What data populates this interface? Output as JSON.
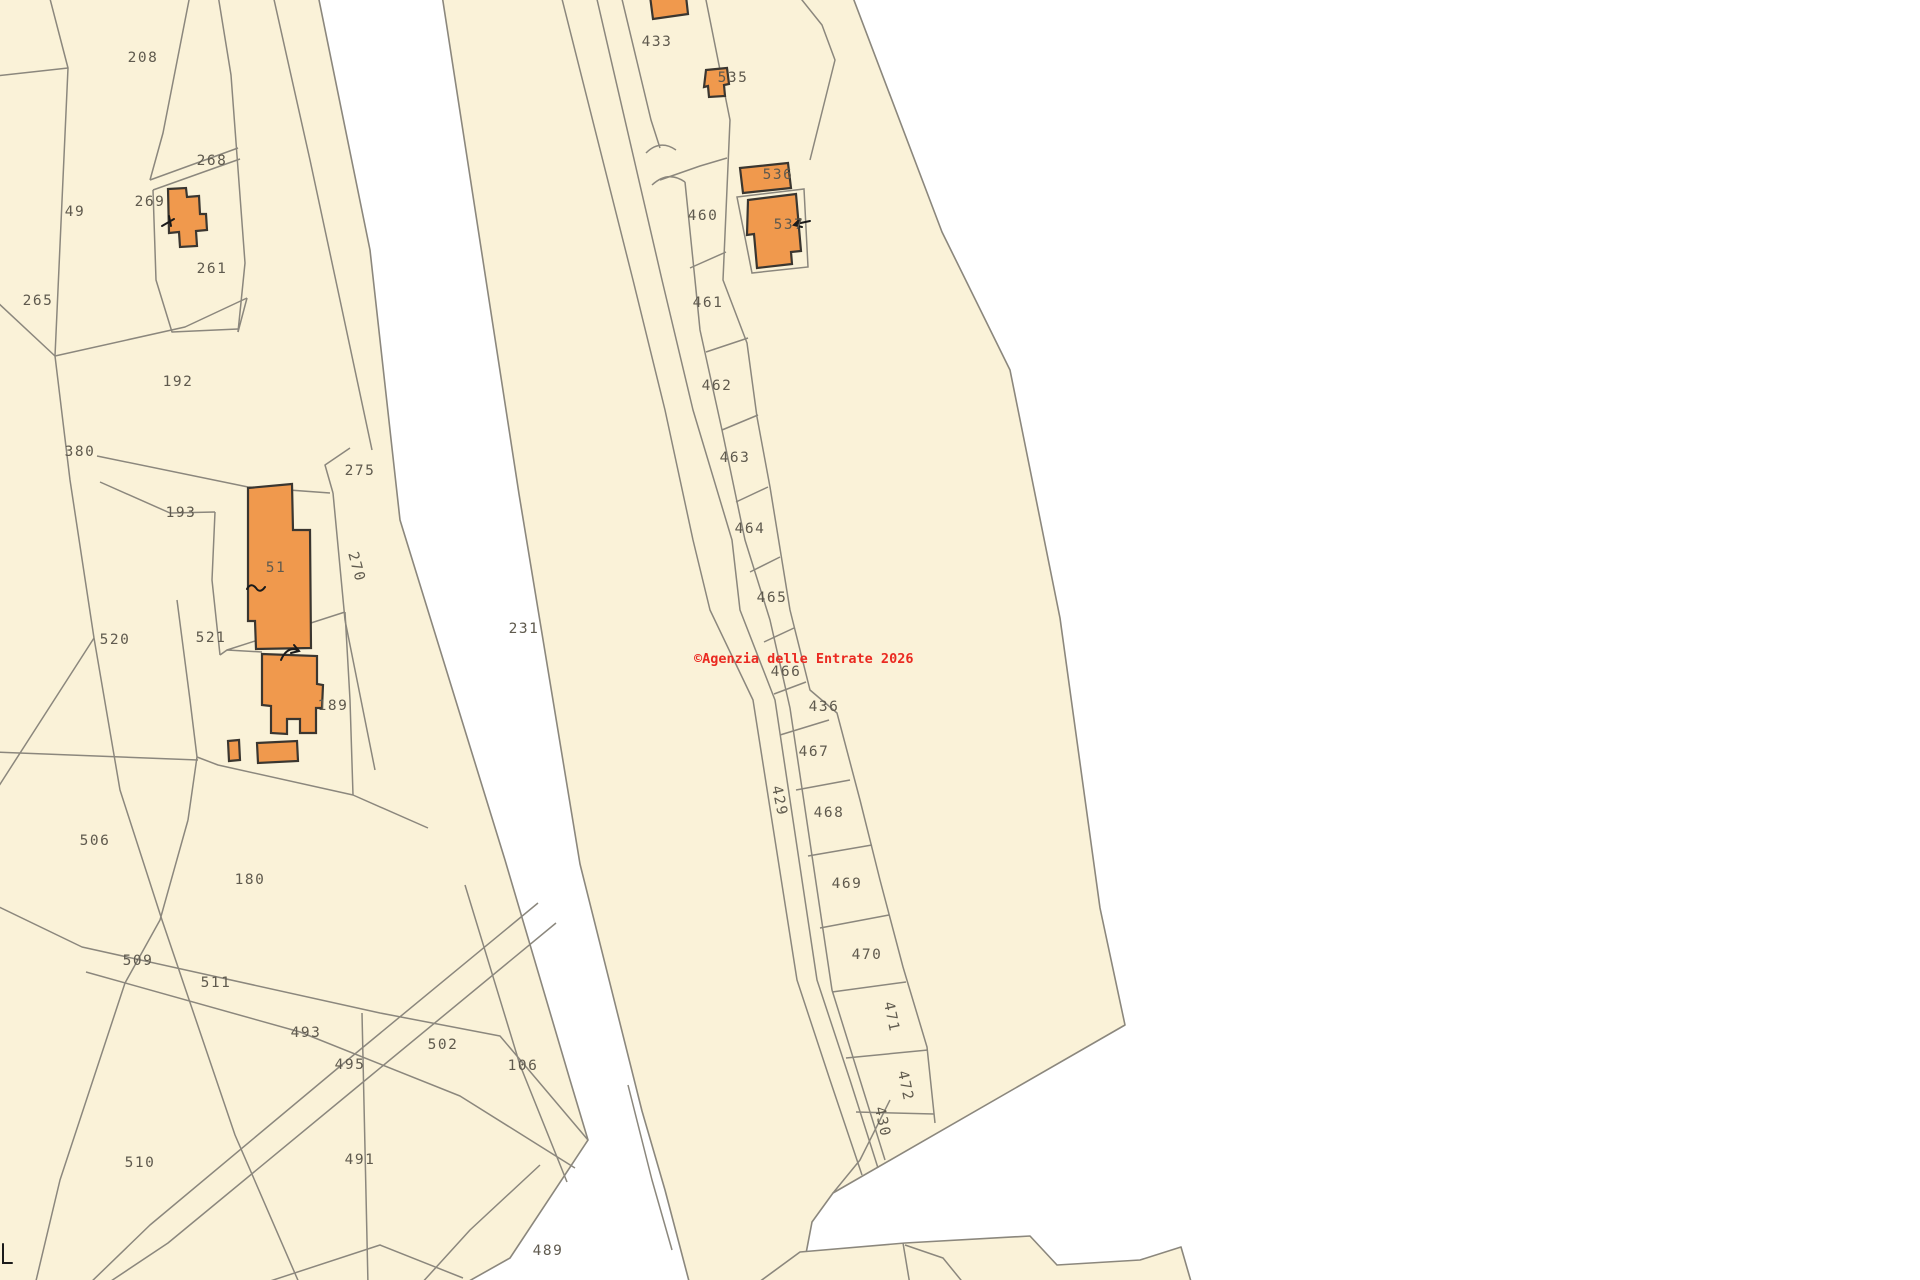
{
  "map": {
    "title": "cadastral-map",
    "width": 1920,
    "height": 1280,
    "colors": {
      "background": "#ffffff",
      "parcel_fill": "#faf2d8",
      "line": "#8b877d",
      "building_fill": "#f0994d",
      "building_stroke": "#3a3630",
      "label": "#5f5a4e",
      "watermark": "#ea2a21",
      "mark": "#1a1a1a"
    },
    "watermark": {
      "text": "©Agenzia delle Entrate 2026",
      "x": 694,
      "y": 663,
      "font_size": 13.5
    },
    "regions": [
      {
        "name": "left-parcel-group",
        "points": "-5,-5 318,-5 370,250 400,520 505,860 570,1080 588,1140 510,1258 462,1285 -5,1285"
      },
      {
        "name": "central-strip-and-right-parcel",
        "points": "442,-5 852,-5 942,232 1010,370 1060,618 1100,908 1125,1025 833,1193 812,1222 800,1285 690,1285 665,1190 642,1111 580,864 519,494"
      },
      {
        "name": "bottom-band",
        "points": "755,1285 800,1252 905,1243 1030,1236 1057,1265 1140,1260 1181,1247 1192,1285"
      }
    ],
    "lines": [
      {
        "name": "boundary",
        "points": "49,-5 68,68 55,356"
      },
      {
        "name": "boundary",
        "points": "68,68 -5,76"
      },
      {
        "name": "boundary",
        "points": "55,356 -5,300"
      },
      {
        "name": "boundary",
        "points": "55,356 70,480 94,638"
      },
      {
        "name": "boundary",
        "points": "94,638 -5,792"
      },
      {
        "name": "boundary",
        "points": "94,638 120,790 162,920 235,1135 300,1285"
      },
      {
        "name": "boundary",
        "points": "188,820 160,920 125,983 60,1180 35,1285"
      },
      {
        "name": "boundary",
        "points": "-5,752 198,760"
      },
      {
        "name": "boundary",
        "points": "177,600 190,700 197,757 188,820"
      },
      {
        "name": "boundary",
        "points": "197,757 218,765 353,795 428,828"
      },
      {
        "name": "boundary",
        "points": "-5,905 82,947 380,1013 500,1036 588,1140"
      },
      {
        "name": "boundary",
        "points": "86,972 300,1032 460,1096 575,1168"
      },
      {
        "name": "boundary",
        "points": "538,903 350,1058 150,1225 88,1285"
      },
      {
        "name": "boundary",
        "points": "556,923 368,1078 168,1243 105,1285"
      },
      {
        "name": "boundary",
        "points": "362,1013 368,1285"
      },
      {
        "name": "boundary",
        "points": "465,885 520,1065 567,1182"
      },
      {
        "name": "boundary",
        "points": "540,1165 470,1230 420,1285"
      },
      {
        "name": "boundary",
        "points": "463,1278 380,1245 258,1285"
      },
      {
        "name": "boundary",
        "points": "190,-5 163,133 150,180"
      },
      {
        "name": "boundary",
        "points": "150,180 238,148"
      },
      {
        "name": "boundary",
        "points": "153,190 240,159"
      },
      {
        "name": "boundary",
        "points": "218,-5 231,75 245,263 238,332"
      },
      {
        "name": "boundary",
        "points": "153,190 156,280 172,332 238,329"
      },
      {
        "name": "boundary",
        "points": "273,-5 310,160 340,300 372,450"
      },
      {
        "name": "boundary",
        "points": "97,456 248,487 330,493"
      },
      {
        "name": "boundary",
        "points": "100,482 170,513 215,512"
      },
      {
        "name": "boundary",
        "points": "215,512 212,580 220,655"
      },
      {
        "name": "boundary",
        "points": "220,655 227,650 262,652"
      },
      {
        "name": "boundary",
        "points": "350,448 325,465 333,493"
      },
      {
        "name": "boundary",
        "points": "333,493 345,620 375,770"
      },
      {
        "name": "boundary",
        "points": "55,356 185,327 247,298"
      },
      {
        "name": "boundary",
        "points": "247,298 238,332"
      },
      {
        "name": "boundary",
        "points": "227,650 345,612"
      },
      {
        "name": "boundary",
        "points": "345,612 350,700 353,795"
      },
      {
        "name": "boundary",
        "points": "561,-5 633,280 665,410 693,540 710,610 753,700 797,980 830,1080 862,1175"
      },
      {
        "name": "boundary",
        "points": "596,-5 662,280 693,410 732,540 740,610 775,700 817,980 850,1080 878,1168"
      },
      {
        "name": "boundary",
        "points": "621,-5 651,120 660,148"
      },
      {
        "name": "boundary",
        "points": "685,182 695,280 700,330 722,430 745,540 770,620 790,708 832,990 885,1160"
      },
      {
        "name": "boundary",
        "points": "705,-5 730,120 723,280 747,343 757,417 770,487 790,610 810,690 837,713 860,800 880,880 903,967 927,1047 935,1123"
      },
      {
        "name": "boundary",
        "points": "798,-5 822,25 835,60 820,120 810,160"
      },
      {
        "name": "boundary",
        "points": "660,180 700,166 727,158"
      },
      {
        "name": "boundary",
        "points": "690,268 726,252"
      },
      {
        "name": "boundary",
        "points": "706,352 748,338"
      },
      {
        "name": "boundary",
        "points": "722,430 758,415"
      },
      {
        "name": "boundary",
        "points": "736,502 768,487"
      },
      {
        "name": "boundary",
        "points": "750,572 780,557"
      },
      {
        "name": "boundary",
        "points": "764,642 794,628"
      },
      {
        "name": "boundary",
        "points": "774,694 806,682"
      },
      {
        "name": "boundary",
        "points": "780,735 829,720"
      },
      {
        "name": "boundary",
        "points": "796,790 850,780"
      },
      {
        "name": "boundary",
        "points": "808,856 872,845"
      },
      {
        "name": "boundary",
        "points": "820,928 889,915"
      },
      {
        "name": "boundary",
        "points": "832,992 906,982"
      },
      {
        "name": "boundary",
        "points": "846,1058 928,1050"
      },
      {
        "name": "boundary",
        "points": "856,1112 934,1114"
      },
      {
        "name": "boundary",
        "points": "890,1100 860,1160 833,1193"
      },
      {
        "name": "boundary",
        "points": "628,1085 652,1180 672,1250"
      },
      {
        "name": "boundary",
        "points": "903,1243 910,1285"
      },
      {
        "name": "boundary",
        "points": "905,1245 943,1258 965,1285"
      }
    ],
    "arcs": [
      {
        "name": "strip-rounded-end",
        "d": "M646,153 Q660,139 676,150"
      },
      {
        "name": "strip-rounded-start",
        "d": "M652,185 Q668,170 685,182"
      }
    ],
    "plots": [
      {
        "name": "building-537-plot",
        "points": "737,197 804,189 808,267 752,273"
      }
    ],
    "buildings": [
      {
        "name": "building-top-433",
        "points": "650,-4 686,-4 688,14 653,19"
      },
      {
        "name": "building-269",
        "points": "168,189 186,188 187,197 199,196 200,214 206,214 207,230 196,231 197,246 180,247 179,232 169,233"
      },
      {
        "name": "building-51",
        "points": "248,488 292,484 293,530 310,530 311,648 256,649 255,621 248,621"
      },
      {
        "name": "building-189",
        "points": "262,654 317,656 317,684 323,685 322,708 316,708 316,733 300,733 300,719 287,719 287,734 271,733 271,706 262,705"
      },
      {
        "name": "building-small-a",
        "points": "228,741 239,740 240,760 229,761"
      },
      {
        "name": "building-small-b",
        "points": "257,743 297,741 298,761 258,763"
      },
      {
        "name": "building-535",
        "points": "706,70 727,68 729,84 724,85 725,96 709,97 708,86 704,87"
      },
      {
        "name": "building-536",
        "points": "740,168 788,163 791,188 743,193"
      },
      {
        "name": "building-537",
        "points": "748,200 796,194 801,251 791,252 792,264 757,268 754,234 747,235"
      }
    ],
    "marks": [
      {
        "name": "tick-building-269",
        "d": "M162,226 l12,-7 M169,216 l2,10"
      },
      {
        "name": "tilde-building-51",
        "d": "M247,589 q4,-7 9,-1 q4,6 9,-1"
      },
      {
        "name": "arrow-building-189",
        "d": "M281,660 Q287,646 298,650 M294,645 l5,6 l-8,2"
      },
      {
        "name": "arrow-building-537",
        "d": "M810,221 l-14,3 M800,219 l-6,6 l8,2"
      },
      {
        "name": "sheet-corner-mark",
        "d": "M3,1244 V1263 H12"
      }
    ],
    "labels": [
      {
        "text": "208",
        "x": 143,
        "y": 58
      },
      {
        "text": "268",
        "x": 212,
        "y": 161
      },
      {
        "text": "269",
        "x": 150,
        "y": 202
      },
      {
        "text": "49",
        "x": 75,
        "y": 212
      },
      {
        "text": "261",
        "x": 212,
        "y": 269
      },
      {
        "text": "265",
        "x": 38,
        "y": 301
      },
      {
        "text": "192",
        "x": 178,
        "y": 382
      },
      {
        "text": "380",
        "x": 80,
        "y": 452
      },
      {
        "text": "275",
        "x": 360,
        "y": 471
      },
      {
        "text": "193",
        "x": 181,
        "y": 513
      },
      {
        "text": "51",
        "x": 276,
        "y": 568
      },
      {
        "text": "270",
        "x": 356,
        "y": 567,
        "r": 75
      },
      {
        "text": "520",
        "x": 115,
        "y": 640
      },
      {
        "text": "521",
        "x": 211,
        "y": 638
      },
      {
        "text": "189",
        "x": 333,
        "y": 706
      },
      {
        "text": "506",
        "x": 95,
        "y": 841
      },
      {
        "text": "180",
        "x": 250,
        "y": 880
      },
      {
        "text": "509",
        "x": 138,
        "y": 961
      },
      {
        "text": "511",
        "x": 216,
        "y": 983
      },
      {
        "text": "493",
        "x": 306,
        "y": 1033
      },
      {
        "text": "495",
        "x": 350,
        "y": 1065
      },
      {
        "text": "502",
        "x": 443,
        "y": 1045
      },
      {
        "text": "106",
        "x": 523,
        "y": 1066
      },
      {
        "text": "510",
        "x": 140,
        "y": 1163
      },
      {
        "text": "491",
        "x": 360,
        "y": 1160
      },
      {
        "text": "489",
        "x": 548,
        "y": 1251
      },
      {
        "text": "433",
        "x": 657,
        "y": 42
      },
      {
        "text": "535",
        "x": 733,
        "y": 78
      },
      {
        "text": "460",
        "x": 703,
        "y": 216
      },
      {
        "text": "536",
        "x": 778,
        "y": 175
      },
      {
        "text": "537",
        "x": 789,
        "y": 225
      },
      {
        "text": "461",
        "x": 708,
        "y": 303
      },
      {
        "text": "462",
        "x": 717,
        "y": 386
      },
      {
        "text": "463",
        "x": 735,
        "y": 458
      },
      {
        "text": "464",
        "x": 750,
        "y": 529
      },
      {
        "text": "465",
        "x": 772,
        "y": 598
      },
      {
        "text": "466",
        "x": 786,
        "y": 672
      },
      {
        "text": "436",
        "x": 824,
        "y": 707
      },
      {
        "text": "467",
        "x": 814,
        "y": 752
      },
      {
        "text": "468",
        "x": 829,
        "y": 813
      },
      {
        "text": "429",
        "x": 779,
        "y": 801,
        "r": 78
      },
      {
        "text": "469",
        "x": 847,
        "y": 884
      },
      {
        "text": "470",
        "x": 867,
        "y": 955
      },
      {
        "text": "471",
        "x": 891,
        "y": 1017,
        "r": 78
      },
      {
        "text": "472",
        "x": 905,
        "y": 1086,
        "r": 78
      },
      {
        "text": "430",
        "x": 882,
        "y": 1122,
        "r": 78
      },
      {
        "text": "231",
        "x": 524,
        "y": 629
      }
    ]
  }
}
